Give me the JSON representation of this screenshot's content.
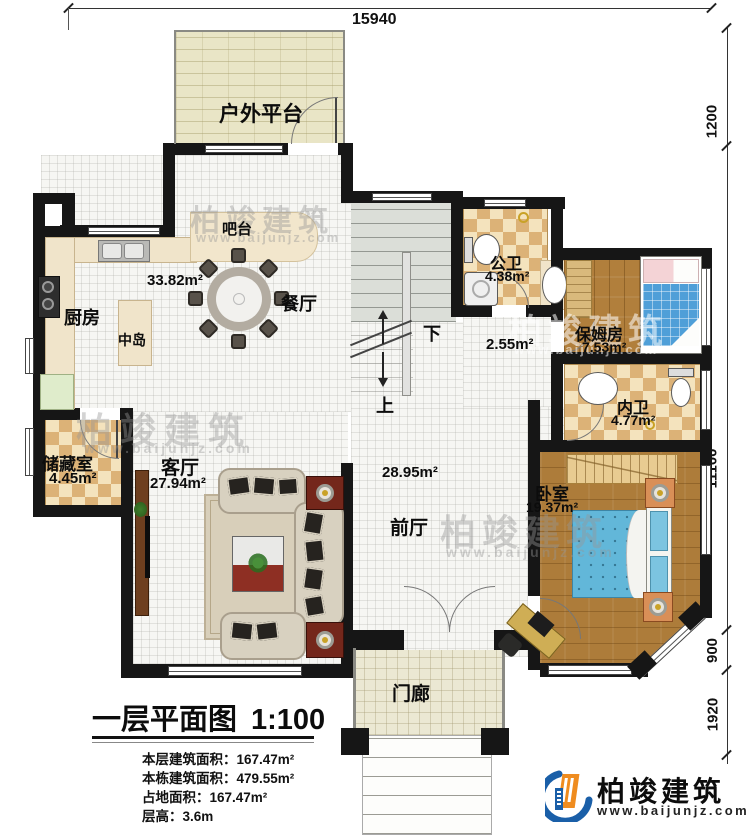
{
  "plan": {
    "dim_top": "15940",
    "dims_right": {
      "d1": "1200",
      "d2": "11100",
      "d3": "900",
      "d4": "1920"
    },
    "labels": {
      "outdoor_platform": "户外平台",
      "bar": "吧台",
      "kitchen": "厨房",
      "kitchen_dining_area": "33.82m²",
      "dining": "餐厅",
      "island": "中岛",
      "public_bath": "公卫",
      "public_bath_area": "4.38m²",
      "hall_area": "2.55m²",
      "stair_down": "下",
      "stair_up": "上",
      "nanny_room": "保姆房",
      "nanny_room_area": "7.53m²",
      "inner_bath": "内卫",
      "inner_bath_area": "4.77m²",
      "storage": "储藏室",
      "storage_area": "4.45m²",
      "living": "客厅",
      "living_area": "27.94m²",
      "foyer": "前厅",
      "foyer_area": "28.95m²",
      "bedroom": "卧室",
      "bedroom_area": "19.37m²",
      "porch": "门廊"
    }
  },
  "title_block": {
    "title": "一层平面图",
    "scale": "1:100",
    "stats": [
      {
        "label": "本层建筑面积：",
        "value": "167.47m²"
      },
      {
        "label": "本栋建筑面积：",
        "value": "479.55m²"
      },
      {
        "label": "占地面积：",
        "value": "167.47m²"
      },
      {
        "label": "层高：",
        "value": "3.6m"
      }
    ]
  },
  "brand": {
    "name": "柏竣建筑",
    "url": "www.baijunjz.com"
  },
  "watermark": {
    "name": "柏竣建筑",
    "url": "www.baijunjz.com"
  },
  "colors": {
    "wall": "#161616",
    "checker_dark": "#dcb277",
    "wood": "#b17f3c",
    "bed_blue": "#5fb5d8",
    "accent_blue": "#1a5fa8",
    "accent_orange": "#ef8c1f"
  }
}
